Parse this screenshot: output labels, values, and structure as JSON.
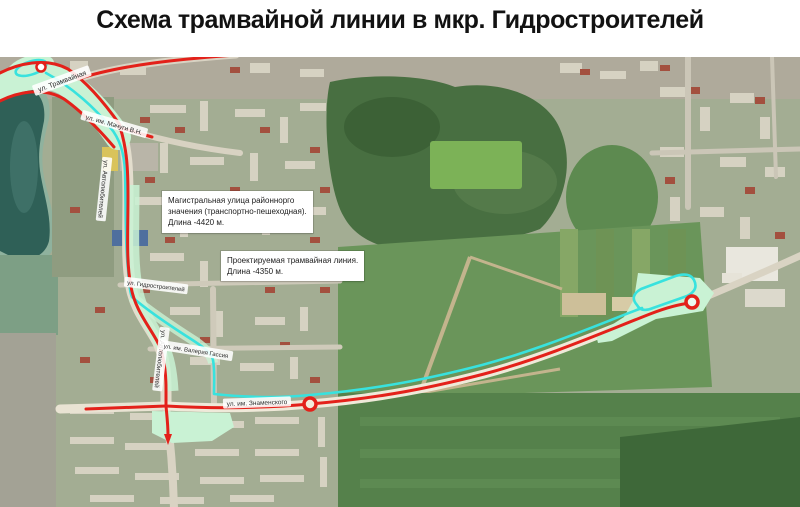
{
  "title": "Схема трамвайной линии в мкр. Гидростроителей",
  "map": {
    "annotations": {
      "main_street": {
        "line1": "Магистральная улица районнорго",
        "line2": "значения (транспортно-пешеходная).",
        "line3": "Длина -4420 м."
      },
      "tram_line": {
        "line1": "Проектируемая трамвайная линия.",
        "line2": "Длина -4350 м."
      }
    },
    "streets": {
      "tramvaynaya": "ул. Трамвайная",
      "machugi": "ул. им. Мачуги В.Н.",
      "avtolyubiteley": "ул. Автолюбителей",
      "gidrostroiteley": "ул. Гидростроителей",
      "gassiya": "ул. им. Валерия Гассия",
      "znamenskogo": "ул. им. Знаменского"
    },
    "colors": {
      "tram_route_red": "#e3211a",
      "proposed_line_cyan": "#38e2de",
      "highlight_mint": "#c9f2d4"
    }
  }
}
